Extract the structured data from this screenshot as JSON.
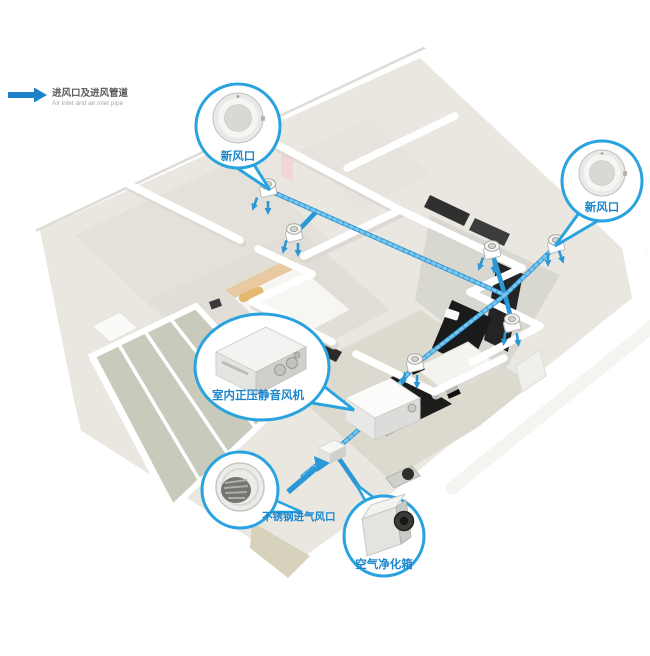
{
  "legend": {
    "label_zh": "进风口及进风管道",
    "label_en": "Air inlet and air inlet pipe"
  },
  "callouts": {
    "top_fresh_air_vent": {
      "label": "新风口"
    },
    "right_fresh_air_vent": {
      "label": "新风口"
    },
    "indoor_fan": {
      "label": "室内正压静音风机"
    },
    "stainless_intake_vent": {
      "label": "不锈钢进气风口"
    },
    "air_purifier": {
      "label": "空气净化箱"
    }
  },
  "colors": {
    "pipe_blue": "#2B97D6",
    "pipe_rib_blue": "#7CC6EC",
    "callout_blue": "#29A3DF",
    "label_blue": "#1B87CD",
    "arrow_blue": "#1E82C8",
    "legend_text": "#58595B",
    "legend_subtext": "#A7A9AC"
  }
}
